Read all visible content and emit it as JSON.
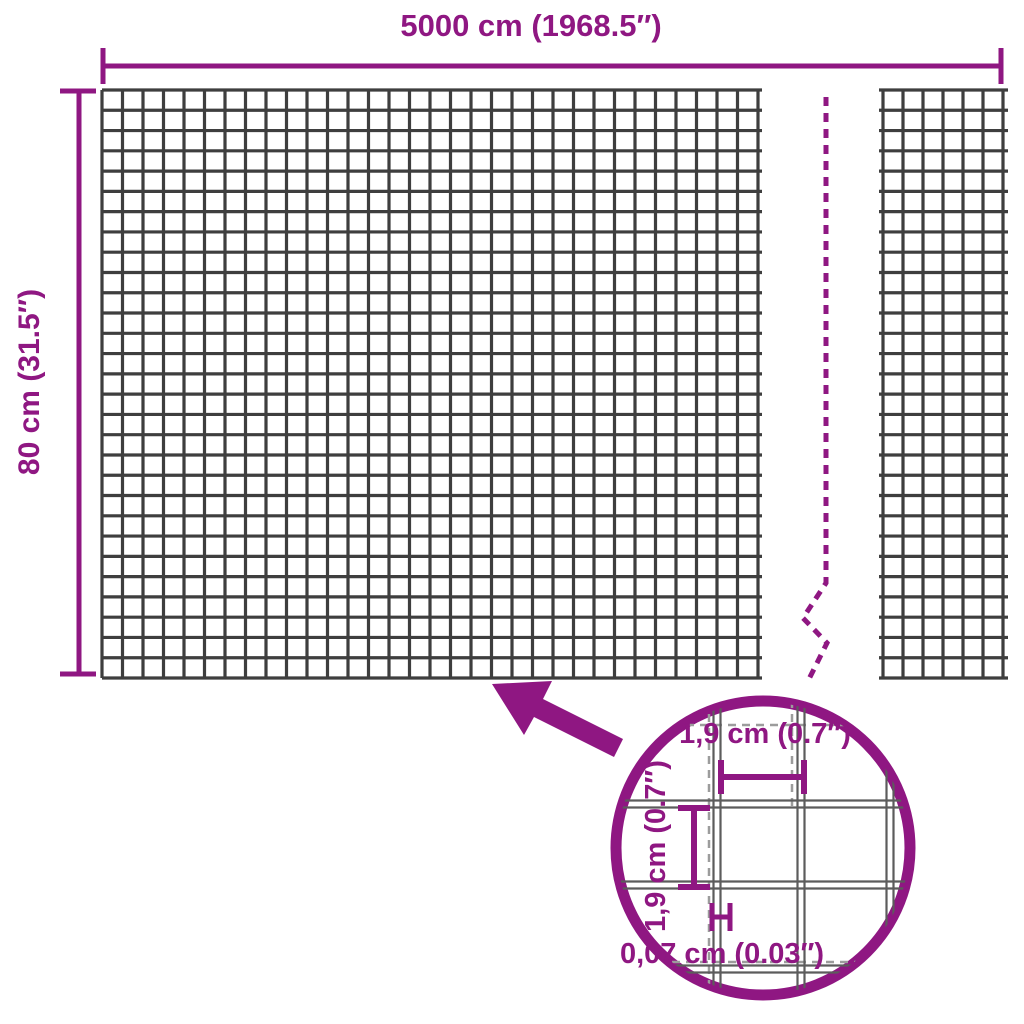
{
  "diagram": {
    "type": "product-dimension-diagram",
    "subject": "welded wire mesh panel",
    "overall": {
      "width_label": "5000 cm (1968.5″)",
      "height_label": "80 cm (31.5″)"
    },
    "detail": {
      "mesh_opening_width_label": "1,9 cm (0.7″)",
      "mesh_opening_height_label": "1,9 cm (0.7″)",
      "wire_thickness_label": "0,07 cm (0.03″)"
    }
  },
  "colors": {
    "accent_purple": "#8F1782",
    "mesh_wire_gray": "#3e3e3e",
    "detail_wire_gray": "#5c5c5c",
    "detail_dash_gray": "#9c9c9c",
    "background": "#ffffff"
  }
}
